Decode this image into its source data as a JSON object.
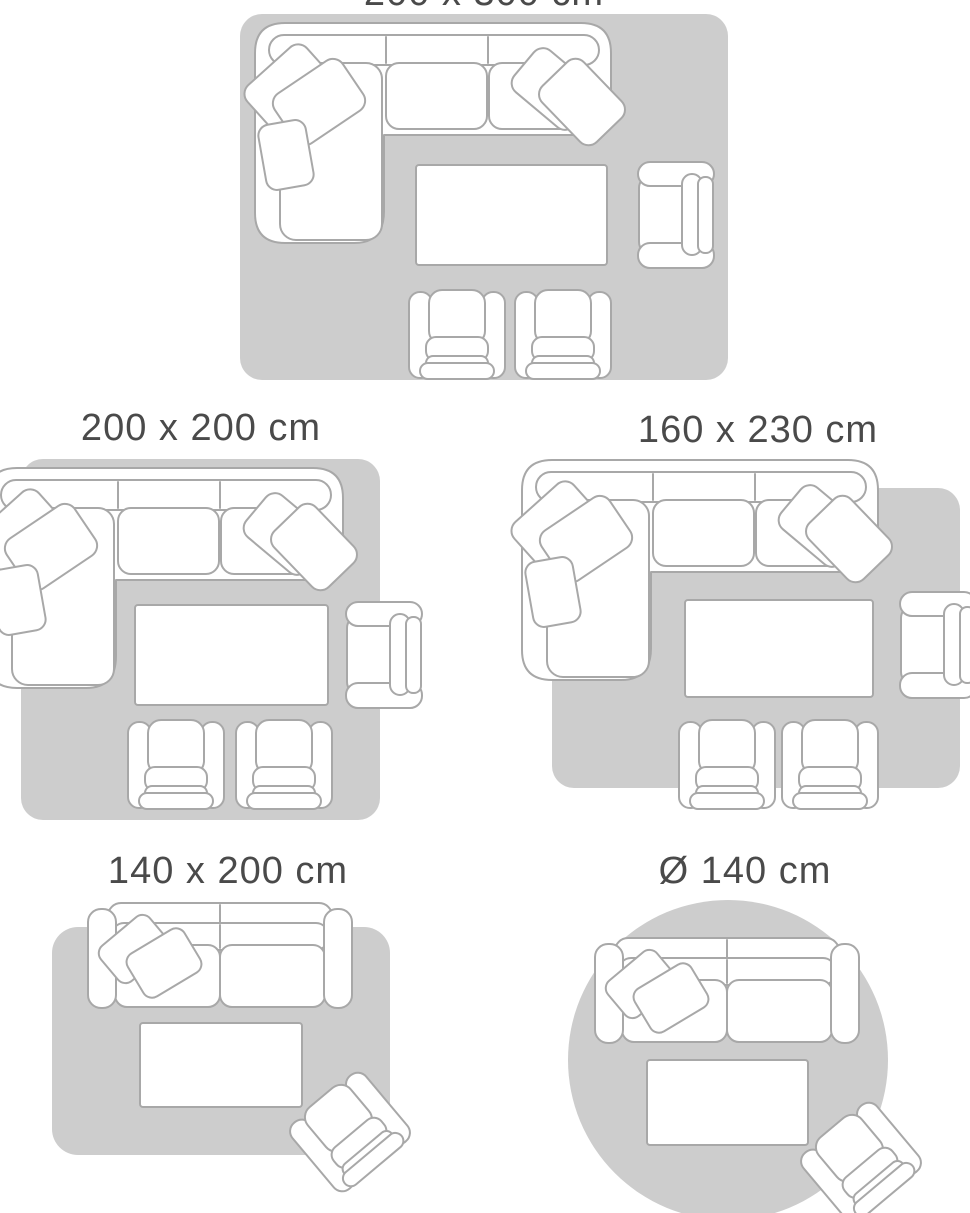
{
  "guide": {
    "sizes": [
      {
        "label": "200 x 300 cm",
        "shape": "rectangle",
        "furniture": [
          "corner-sofa",
          "coffee-table",
          "armchair",
          "armchair",
          "armchair"
        ]
      },
      {
        "label": "200 x 200 cm",
        "shape": "rectangle",
        "furniture": [
          "corner-sofa",
          "coffee-table",
          "armchair",
          "armchair",
          "armchair"
        ]
      },
      {
        "label": "160 x 230 cm",
        "shape": "rectangle",
        "furniture": [
          "corner-sofa",
          "coffee-table",
          "armchair",
          "armchair",
          "armchair"
        ]
      },
      {
        "label": "140 x 200 cm",
        "shape": "rectangle",
        "furniture": [
          "two-seater-sofa",
          "coffee-table",
          "armchair"
        ]
      },
      {
        "label": "Ø 140 cm",
        "shape": "round",
        "furniture": [
          "two-seater-sofa",
          "coffee-table",
          "armchair"
        ]
      }
    ]
  },
  "colors": {
    "rug": "#cdcdcd",
    "outline": "#a8a8a8",
    "furniture": "#ffffff",
    "text": "#4a4a4a",
    "background": "#ffffff"
  }
}
